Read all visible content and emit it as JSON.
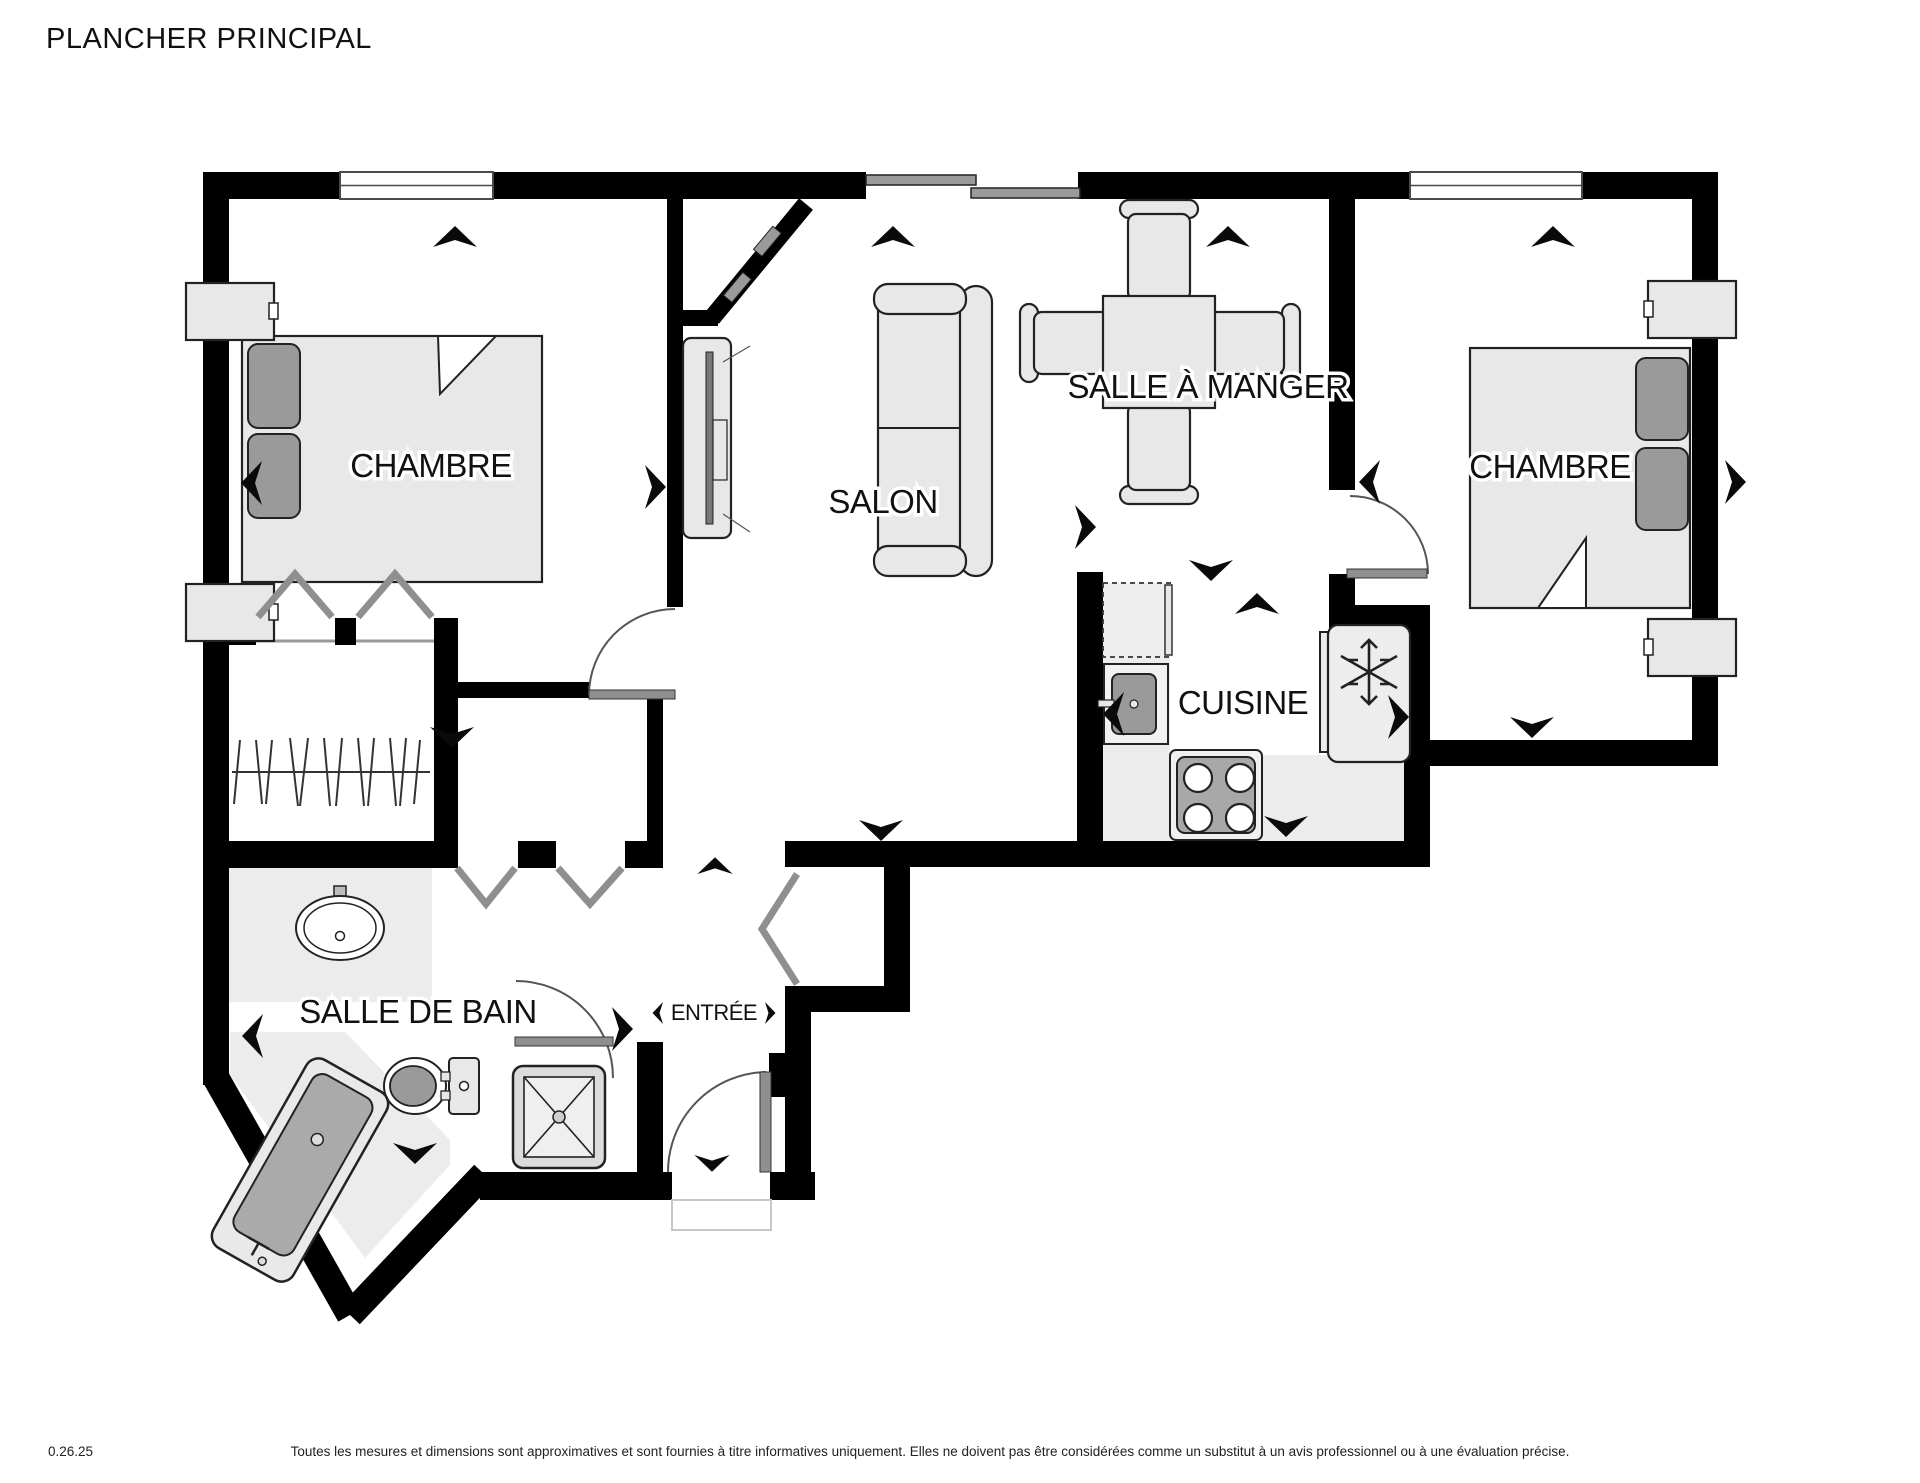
{
  "title": "PLANCHER PRINCIPAL",
  "rooms": {
    "bedroom_left": "CHAMBRE",
    "salon": "SALON",
    "dining": "SALLE À MANGER",
    "bedroom_right": "CHAMBRE",
    "kitchen": "CUISINE",
    "bathroom": "SALLE DE BAIN",
    "entry": "ENTRÉE"
  },
  "footer": {
    "version": "0.26.25",
    "disclaimer": "Toutes les mesures et dimensions sont approximatives et sont fournies à titre informatives uniquement. Elles ne doivent pas être considérées comme un substitut à un avis professionnel ou à une évaluation précise."
  },
  "colors": {
    "wall": "#000000",
    "furniture_fill": "#e8e8e8",
    "furniture_stroke": "#222222",
    "accent_dark_gray": "#9a9a9a",
    "door_gray": "#8f8f8f",
    "floor_light": "#ececec",
    "window_line": "#4a4a4a"
  },
  "icons": {
    "view_direction_arrow": "➤",
    "freezer_snowflake": "❄"
  }
}
